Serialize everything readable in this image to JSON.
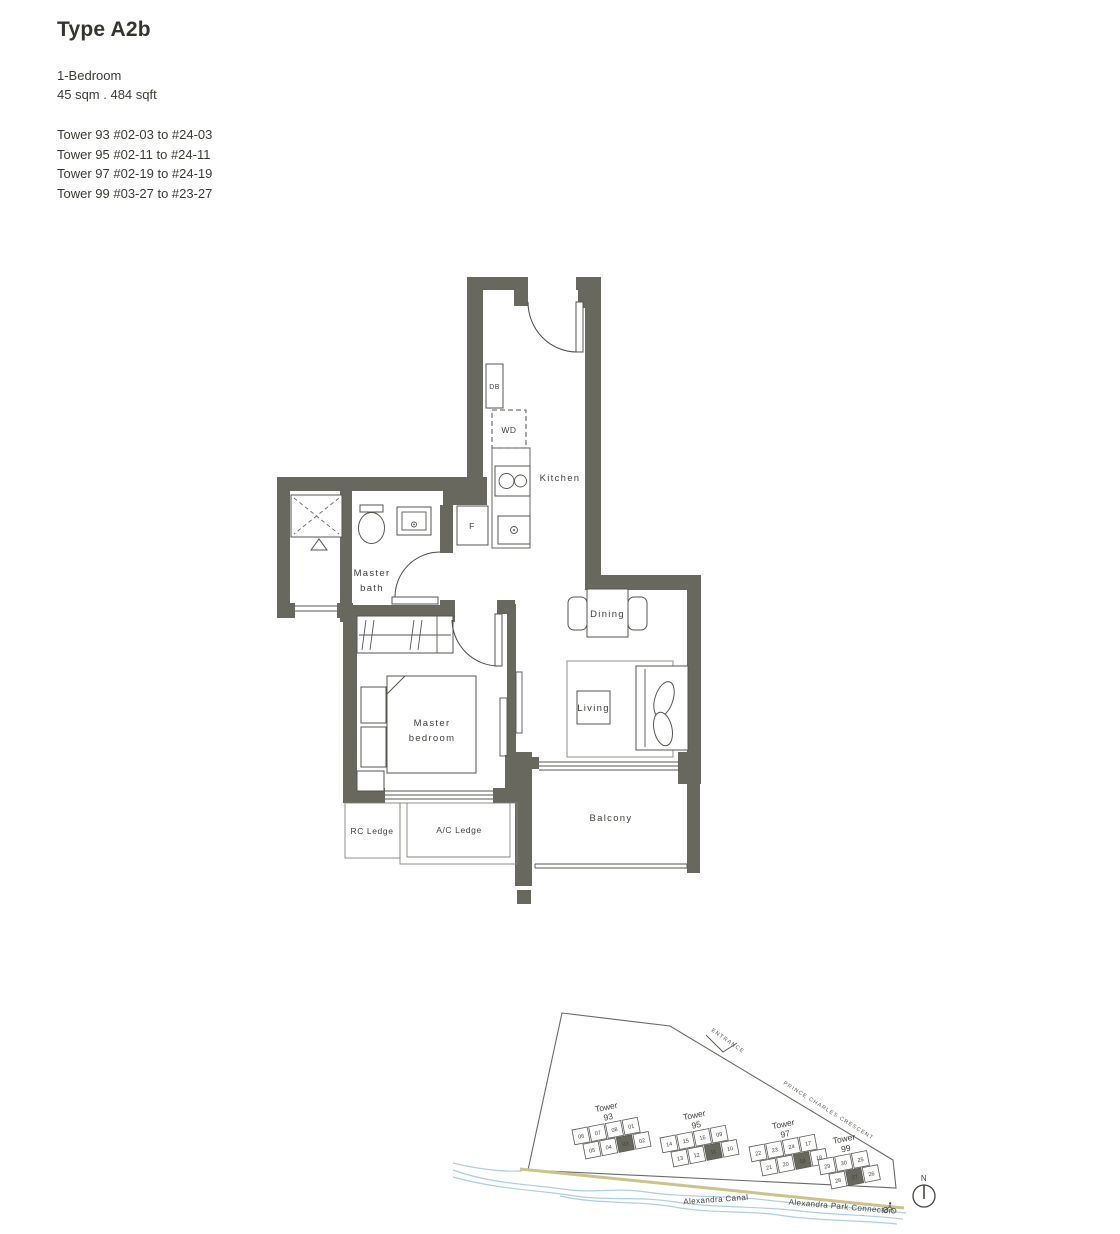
{
  "page": {
    "title": "Type A2b",
    "bedroom_type": "1-Bedroom",
    "area": "45 sqm . 484 sqft",
    "tower_lines": [
      "Tower 93 #02-03 to #24-03",
      "Tower 95 #02-11 to #24-11",
      "Tower 97 #02-19 to #24-19",
      "Tower 99 #03-27 to #23-27"
    ]
  },
  "floorplan": {
    "labels": {
      "db": "DB",
      "wd": "WD",
      "kitchen": "Kitchen",
      "fridge": "F",
      "master_bath_1": "Master",
      "master_bath_2": "bath",
      "dining": "Dining",
      "living": "Living",
      "master_bedroom_1": "Master",
      "master_bedroom_2": "bedroom",
      "rc_ledge": "RC Ledge",
      "ac_ledge": "A/C Ledge",
      "balcony": "Balcony"
    }
  },
  "siteplan": {
    "entrance_label": "ENTRANCE",
    "road_label": "PRINCE CHARLES CRESCENT",
    "canal_label": "Alexandra Canal",
    "connector_label": "Alexandra Park Connector",
    "north_label": "N",
    "towers": [
      {
        "name": "Tower",
        "number": "93",
        "top_units": [
          "06",
          "07",
          "08",
          "01"
        ],
        "bottom_units": [
          "05",
          "04",
          "03",
          "02"
        ],
        "highlighted": "03"
      },
      {
        "name": "Tower",
        "number": "95",
        "top_units": [
          "14",
          "15",
          "16",
          "09"
        ],
        "bottom_units": [
          "13",
          "12",
          "11",
          "10"
        ],
        "highlighted": "11"
      },
      {
        "name": "Tower",
        "number": "97",
        "top_units": [
          "22",
          "23",
          "24",
          "17"
        ],
        "bottom_units": [
          "21",
          "20",
          "19",
          "18"
        ],
        "highlighted": "19"
      },
      {
        "name": "Tower",
        "number": "99",
        "top_units": [
          "29",
          "30",
          "25"
        ],
        "bottom_units": [
          "28",
          "27",
          "26"
        ],
        "highlighted": "27"
      }
    ]
  },
  "colors": {
    "wall": "#68685f",
    "line": "#4a4a46",
    "text": "#3f3f3a",
    "canal": "#aecde6",
    "road": "#cbc28c"
  }
}
